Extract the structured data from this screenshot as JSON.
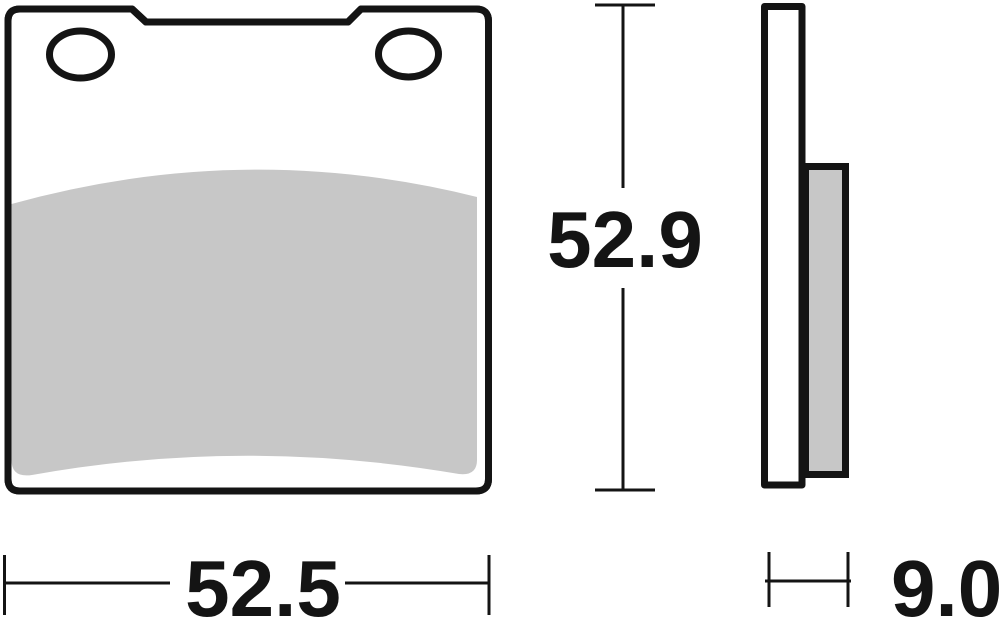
{
  "dimensions": {
    "height": "52.9",
    "width": "52.5",
    "thickness": "9.0"
  },
  "colors": {
    "line": "#141414",
    "friction": "#c7c7c7",
    "background": "#ffffff"
  }
}
